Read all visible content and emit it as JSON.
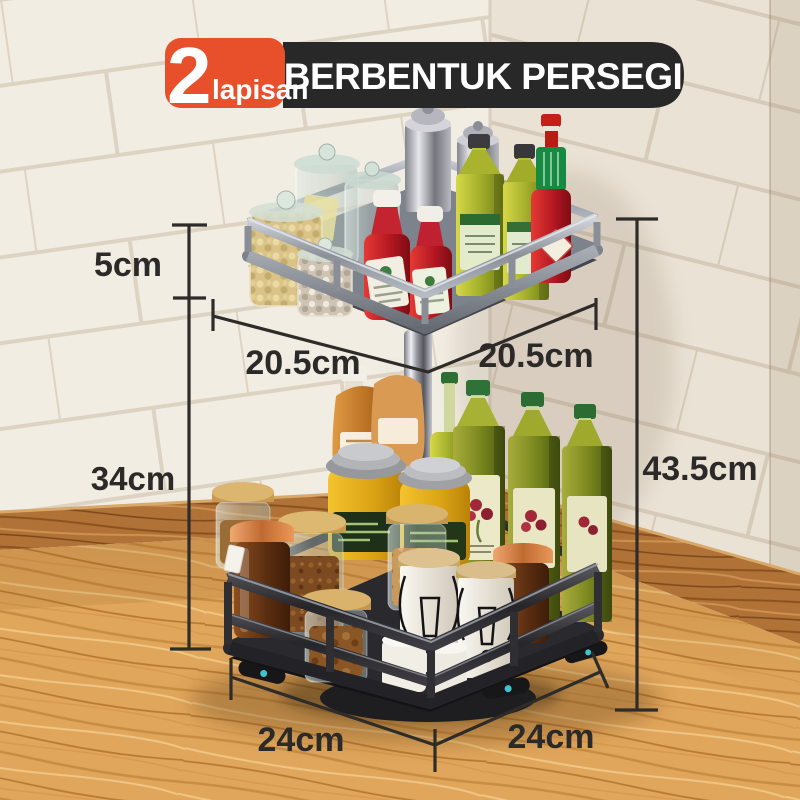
{
  "badge": {
    "number": "2",
    "word": "lapisan",
    "title": "BERBENTUK PERSEGI"
  },
  "dims": {
    "tier_height": "5cm",
    "column_height": "34cm",
    "top_width_left": "20.5cm",
    "top_width_right": "20.5cm",
    "total_height": "43.5cm",
    "base_width_left": "24cm",
    "base_width_right": "24cm"
  },
  "colors": {
    "badge_orange": "#E8502C",
    "badge_dark": "#282828",
    "dimension_line": "#2E2C29",
    "dimension_text": "#2B2A28",
    "tile_wall": "#F2EDE3",
    "tile_grout": "#DDD3C2",
    "counter_wood": "#E0A65C",
    "trim_wood": "#B07236",
    "rack_top_metal": "#9AA0A8",
    "rack_bottom_metal": "#2A2A2E",
    "pole_chrome": "#C9C9D1",
    "turntable_foot_dot": "#3EC4CC"
  },
  "scene_items": [
    "two-tier-square-rotating-spice-rack",
    "steel-shaker",
    "glass-storage-jar",
    "chickpea-jar",
    "pearl-jar",
    "ketchup-bottle",
    "olive-oil-bottle",
    "tabasco-bottle",
    "chrome-center-pole",
    "dressing-bottle",
    "yellow-spice-jar",
    "bamboo-lid-spice-jar",
    "copper-lid-amber-jar",
    "white-swing-top-jar",
    "turntable-base"
  ]
}
